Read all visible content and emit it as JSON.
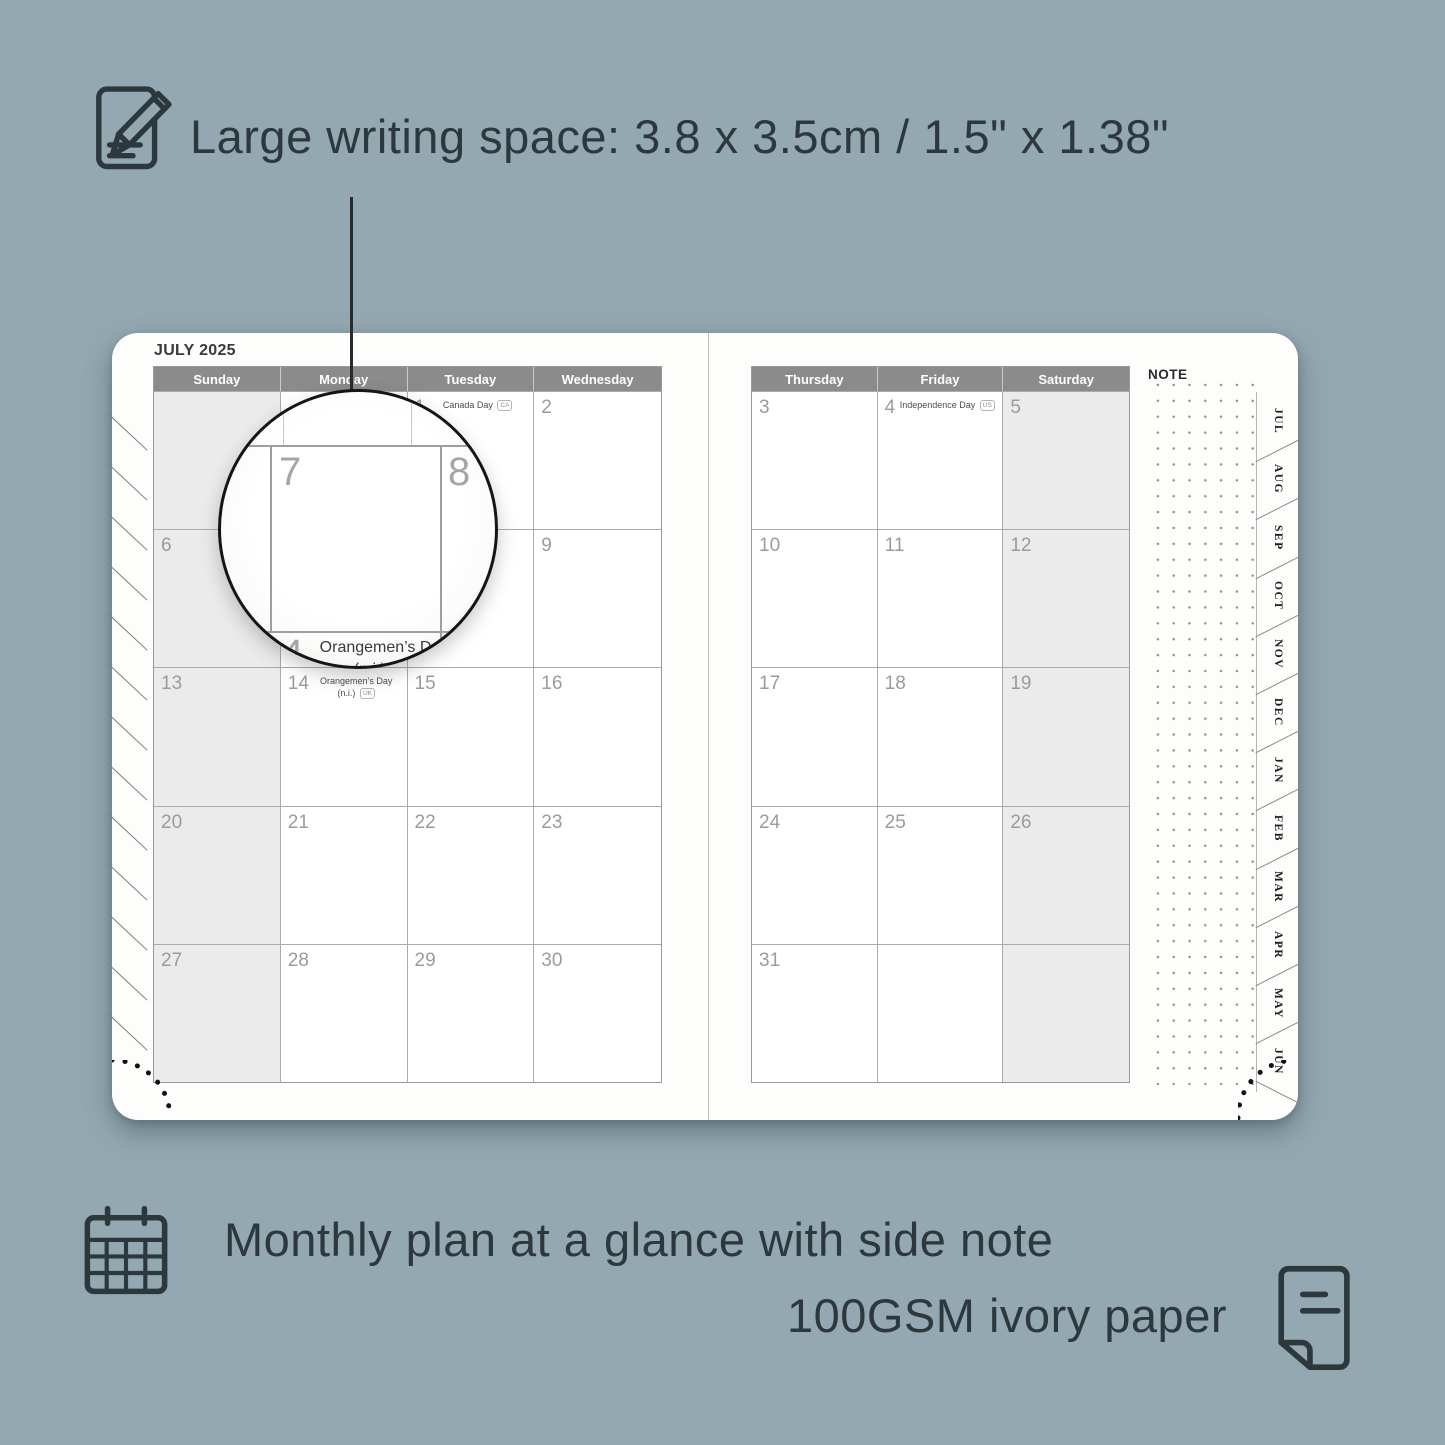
{
  "colors": {
    "background": "#94a8b2",
    "text_dark": "#2d383d",
    "page_white": "#fdfdfc",
    "header_bar": "#8b8b8b",
    "shaded_cell": "#ebebeb",
    "grid_line": "#ababab",
    "day_number": "#9b9b9b"
  },
  "features": {
    "writing": {
      "label": "Large writing space: 3.8 x 3.5cm / 1.5\" x 1.38\""
    },
    "monthly": {
      "label": "Monthly plan at a glance with side note"
    },
    "paper": {
      "label": "100GSM ivory paper"
    }
  },
  "planner": {
    "month_title": "JULY 2025",
    "note_label": "NOTE",
    "left_page": {
      "shaded_column": 0,
      "headers": [
        "Sunday",
        "Monday",
        "Tuesday",
        "Wednesday"
      ],
      "weeks": [
        [
          {
            "day": ""
          },
          {
            "day": ""
          },
          {
            "day": "1",
            "holiday": "Canada Day",
            "badge": "CA",
            "wrap": false
          },
          {
            "day": "2"
          }
        ],
        [
          {
            "day": "6"
          },
          {
            "day": "7"
          },
          {
            "day": "8"
          },
          {
            "day": "9"
          }
        ],
        [
          {
            "day": "13"
          },
          {
            "day": "14",
            "holiday": "Orangemen’s Day (n.i.)",
            "badge": "UK",
            "wrap": true
          },
          {
            "day": "15"
          },
          {
            "day": "16"
          }
        ],
        [
          {
            "day": "20"
          },
          {
            "day": "21"
          },
          {
            "day": "22"
          },
          {
            "day": "23"
          }
        ],
        [
          {
            "day": "27"
          },
          {
            "day": "28"
          },
          {
            "day": "29"
          },
          {
            "day": "30"
          }
        ]
      ]
    },
    "right_page": {
      "shaded_column": 2,
      "headers": [
        "Thursday",
        "Friday",
        "Saturday"
      ],
      "weeks": [
        [
          {
            "day": "3"
          },
          {
            "day": "4",
            "holiday": "Independence Day",
            "badge": "US",
            "wrap": false
          },
          {
            "day": "5"
          }
        ],
        [
          {
            "day": "10"
          },
          {
            "day": "11"
          },
          {
            "day": "12"
          }
        ],
        [
          {
            "day": "17"
          },
          {
            "day": "18"
          },
          {
            "day": "19"
          }
        ],
        [
          {
            "day": "24"
          },
          {
            "day": "25"
          },
          {
            "day": "26"
          }
        ],
        [
          {
            "day": "31"
          },
          {
            "day": ""
          },
          {
            "day": ""
          }
        ]
      ]
    },
    "tabs": [
      "JUL",
      "AUG",
      "SEP",
      "OCT",
      "NOV",
      "DEC",
      "JAN",
      "FEB",
      "MAR",
      "APR",
      "MAY",
      "JUN"
    ]
  },
  "magnifier": {
    "top_left_day": "7",
    "top_right_day": "8",
    "bottom_day": "14",
    "holiday_line1": "Orangemen’s Day",
    "holiday_line2": "(n.i.)",
    "badge": "UK"
  }
}
